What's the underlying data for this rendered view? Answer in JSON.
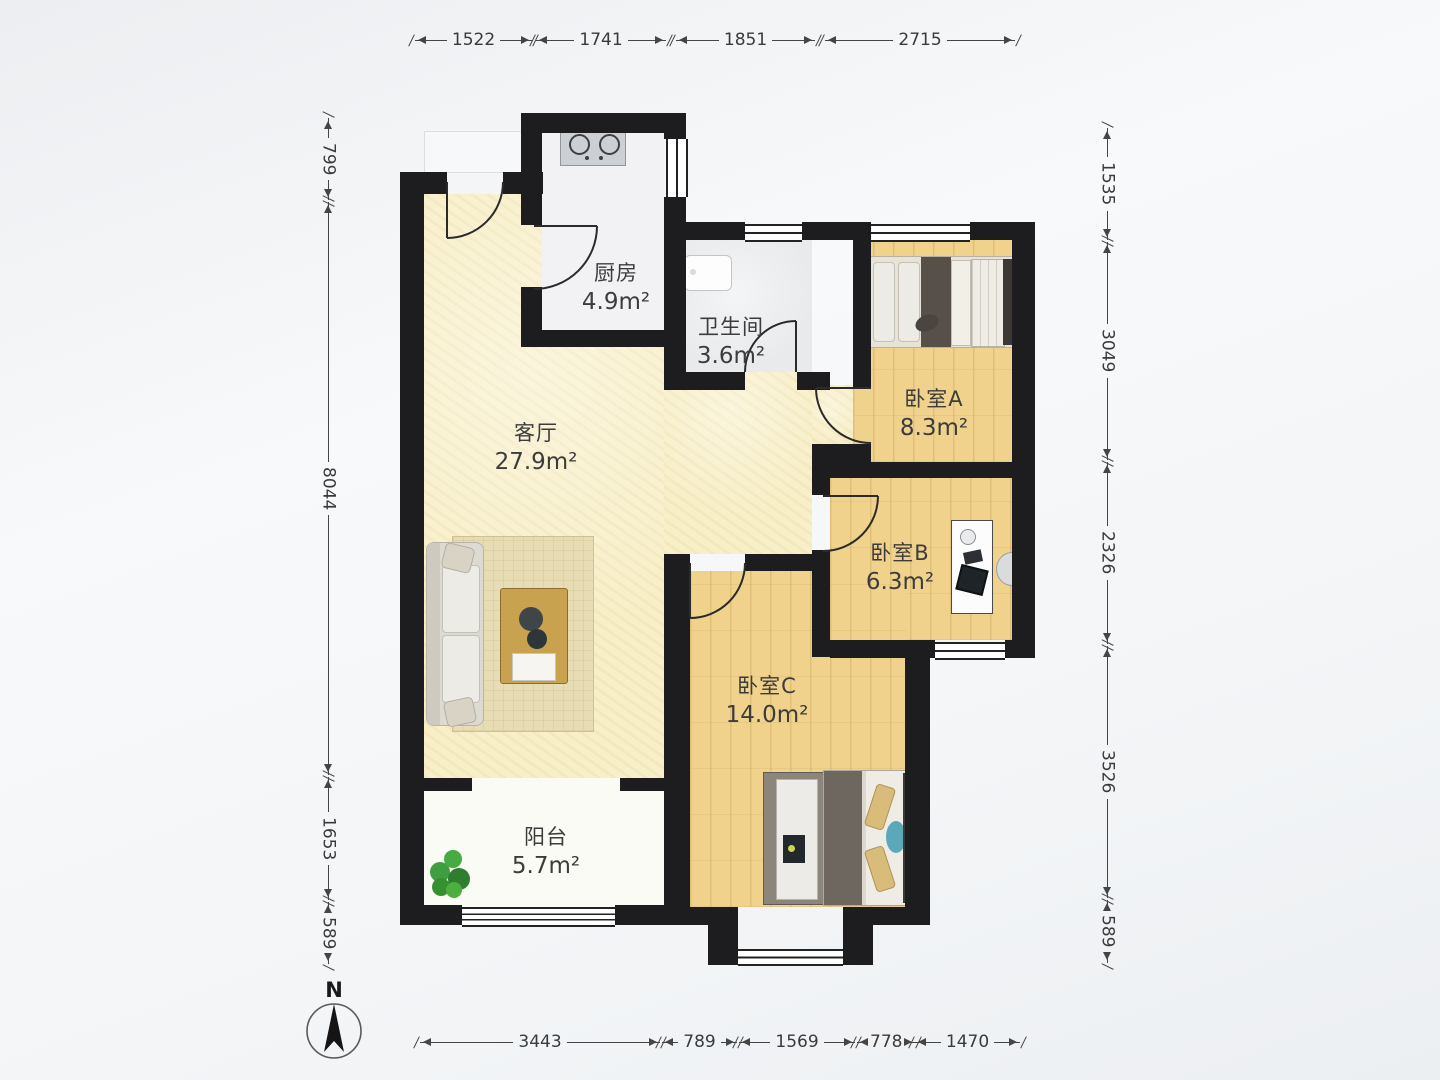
{
  "plan": {
    "rooms": {
      "kitchen": {
        "name": "厨房",
        "area": "4.9m²"
      },
      "bathroom": {
        "name": "卫生间",
        "area": "3.6m²"
      },
      "living": {
        "name": "客厅",
        "area": "27.9m²"
      },
      "bedroomA": {
        "name": "卧室A",
        "area": "8.3m²"
      },
      "bedroomB": {
        "name": "卧室B",
        "area": "6.3m²"
      },
      "bedroomC": {
        "name": "卧室C",
        "area": "14.0m²"
      },
      "balcony": {
        "name": "阳台",
        "area": "5.7m²"
      }
    },
    "compass": {
      "label": "N"
    }
  },
  "dimensions": {
    "top": [
      "1522",
      "1741",
      "1851",
      "2715"
    ],
    "bottom": [
      "3443",
      "789",
      "1569",
      "778",
      "1470"
    ],
    "left": [
      "799",
      "8044",
      "1653",
      "589"
    ],
    "right": [
      "1535",
      "3049",
      "2326",
      "3526",
      "589"
    ]
  },
  "colors": {
    "wall": "#1d1d1f",
    "wood_floor": "#f0d28d",
    "living_floor": "#f8efc9",
    "bath_floor": "#e9eaec",
    "dim_line": "#454545"
  }
}
